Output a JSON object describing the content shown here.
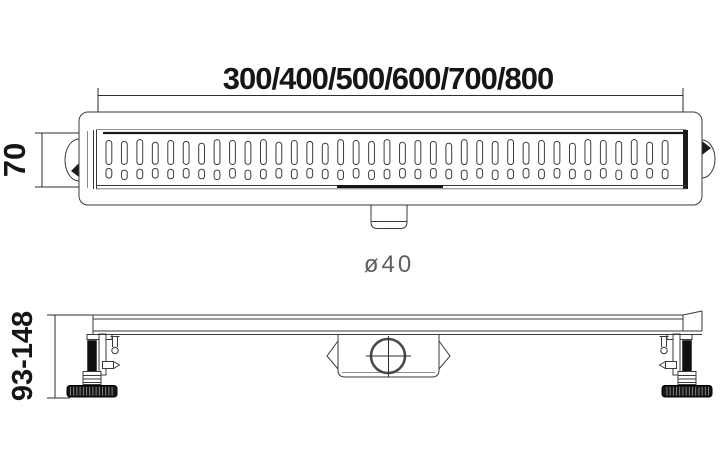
{
  "drawing": {
    "length_dimension": "300/400/500/600/700/800",
    "width_dimension": "70",
    "outlet_diameter": "ø40",
    "height_dimension": "93-148"
  },
  "grate": {
    "slot_columns": 37,
    "slot_rows": 2
  },
  "colors": {
    "background": "#ffffff",
    "line": "#3a3a3a",
    "dark": "#1b1b1b",
    "dim_text": "#161616",
    "outlet_text": "#5f5f5f"
  }
}
